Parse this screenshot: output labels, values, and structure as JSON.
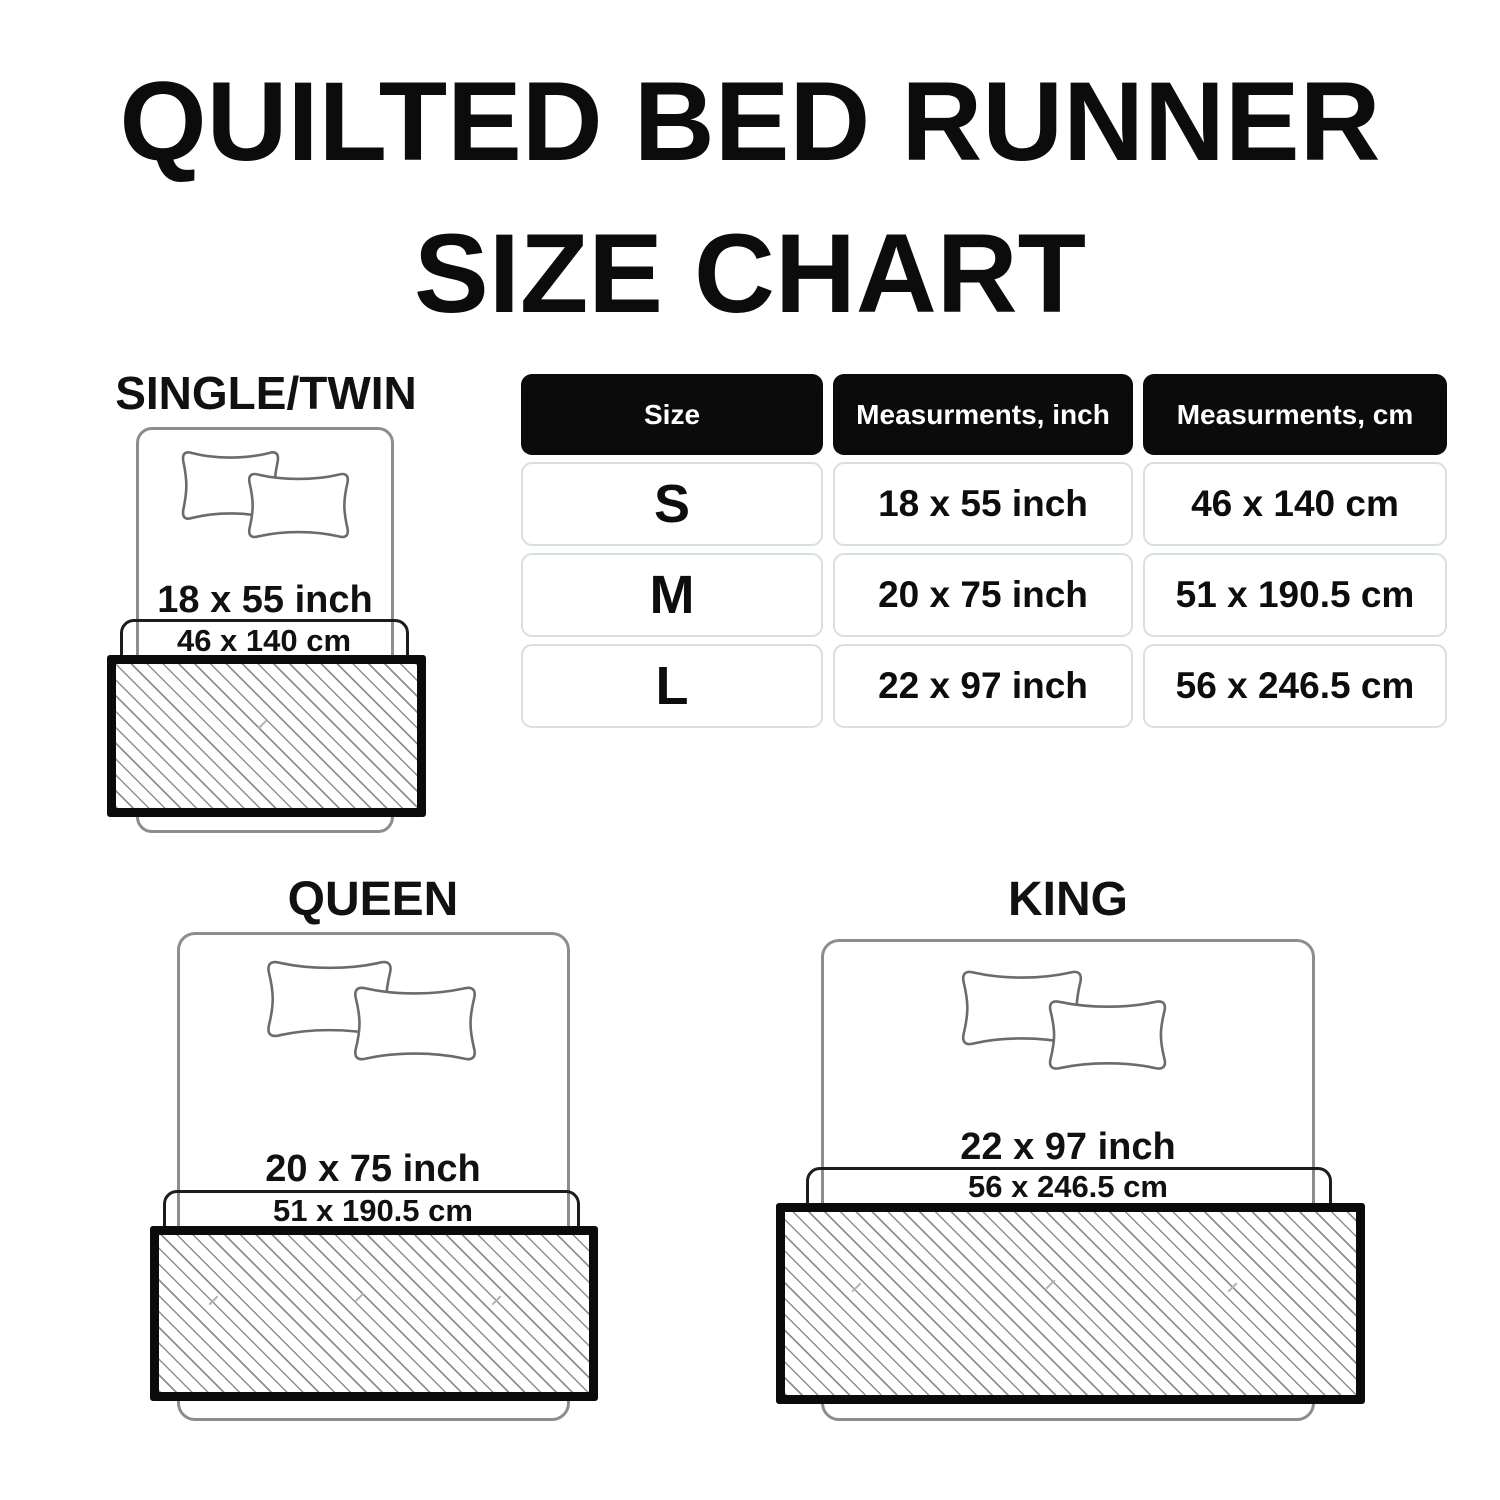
{
  "title": {
    "line1": "QUILTED BED RUNNER",
    "line2": "SIZE CHART"
  },
  "table": {
    "headers": [
      "Size",
      "Measurments, inch",
      "Measurments, cm"
    ],
    "rows": [
      {
        "size": "S",
        "inch": "18 x 55 inch",
        "cm": "46 x 140 cm"
      },
      {
        "size": "M",
        "inch": "20 x 75 inch",
        "cm": "51 x 190.5 cm"
      },
      {
        "size": "L",
        "inch": "22 x 97 inch",
        "cm": "56 x 246.5 cm"
      }
    ]
  },
  "sections": [
    {
      "name": "SINGLE/TWIN",
      "inch": "18 x 55 inch",
      "cm": "46 x 140 cm"
    },
    {
      "name": "QUEEN",
      "inch": "20 x 75 inch",
      "cm": "51 x 190.5 cm"
    },
    {
      "name": "KING",
      "inch": "22 x 97 inch",
      "cm": "56 x 246.5 cm"
    }
  ],
  "colors": {
    "text": "#0d0d0d",
    "header_bg": "#0b0b0b",
    "header_text": "#ffffff",
    "cell_border": "#d8dfe2",
    "bed_outline": "#8d8d8d",
    "pillow_outline": "#6b6b6b",
    "cm_box_border": "#1c1c1c",
    "runner_border": "#0b0b0b",
    "hatch_line": "#8f8f8f"
  }
}
